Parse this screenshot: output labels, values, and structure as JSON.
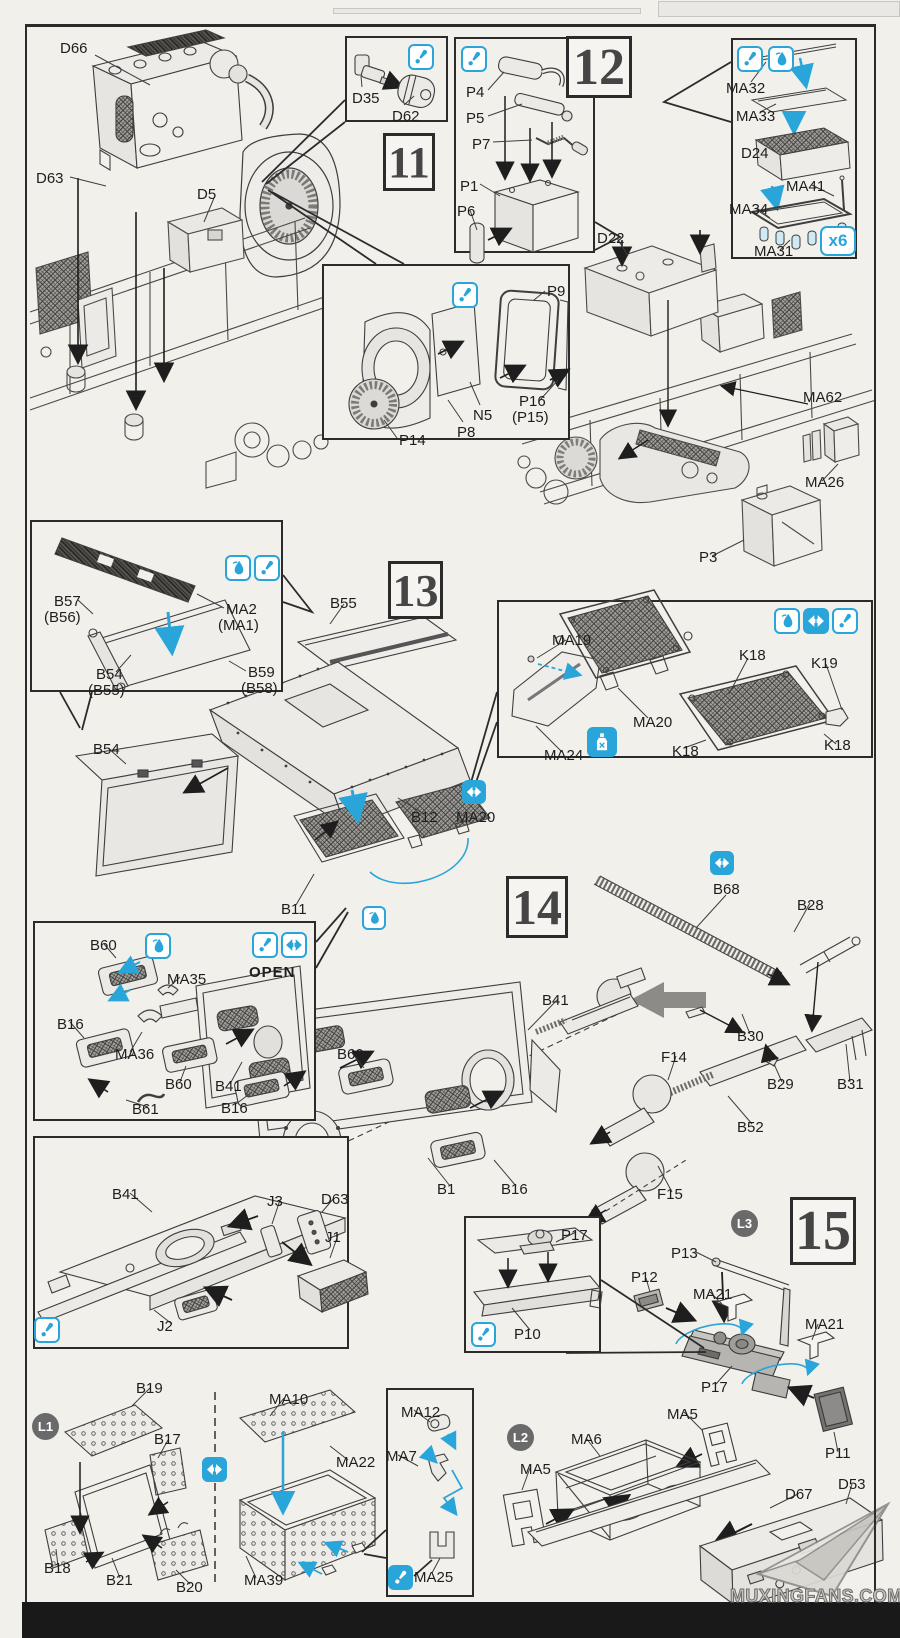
{
  "document": {
    "type": "model-kit-assembly-instructions",
    "watermark": "MUXINGFANS.COM"
  },
  "colors": {
    "paper": "#f2f0eb",
    "line": "#3e3e3e",
    "accent_cyan": "#2aa5da",
    "step_number": "#454545",
    "badge_gray": "#6a6a6a",
    "watermark_gray": "#c6c4bf",
    "bottom_bar": "#191919"
  },
  "steps": [
    {
      "number": "11"
    },
    {
      "number": "12"
    },
    {
      "number": "13"
    },
    {
      "number": "14"
    },
    {
      "number": "15"
    }
  ],
  "badges": {
    "l1": "L1",
    "l2": "L2",
    "l3": "L3",
    "multiplier": "x6",
    "open": "OPEN"
  },
  "icons": {
    "attention": "slanted-exclamation",
    "glue": "glue-drop",
    "optional": "left-right-arrows",
    "cement": "glue-bottle"
  },
  "labels": [
    "D66",
    "D63",
    "D5",
    "D35",
    "D62",
    "P4",
    "P5",
    "P7",
    "P1",
    "P6",
    "MA32",
    "MA33",
    "D24",
    "MA41",
    "MA34",
    "MA31",
    "D22",
    "P9",
    "N5",
    "P16",
    "(P15)",
    "P8",
    "P14",
    "MA62",
    "MA26",
    "P3",
    "B57",
    "(B56)",
    "MA2",
    "(MA1)",
    "B54",
    "(B55)",
    "B59",
    "(B58)",
    "B55",
    "MA19",
    "K18",
    "K19",
    "MA20",
    "MA24",
    "K18",
    "K18",
    "B54",
    "B12",
    "MA20",
    "B11",
    "B60",
    "MA35",
    "B16",
    "MA36",
    "B60",
    "B41",
    "B16",
    "B61",
    "B41",
    "B60",
    "B1",
    "B16",
    "B68",
    "B28",
    "B30",
    "F14",
    "B29",
    "B31",
    "B52",
    "F15",
    "B41",
    "J3",
    "D63",
    "J1",
    "J2",
    "P17",
    "P10",
    "P13",
    "P12",
    "MA21",
    "MA21",
    "P17",
    "MA5",
    "P11",
    "MA6",
    "MA5",
    "D67",
    "D53",
    "B19",
    "B17",
    "B18",
    "B21",
    "B20",
    "MA10",
    "MA22",
    "MA39",
    "MA12",
    "MA7",
    "MA25"
  ]
}
